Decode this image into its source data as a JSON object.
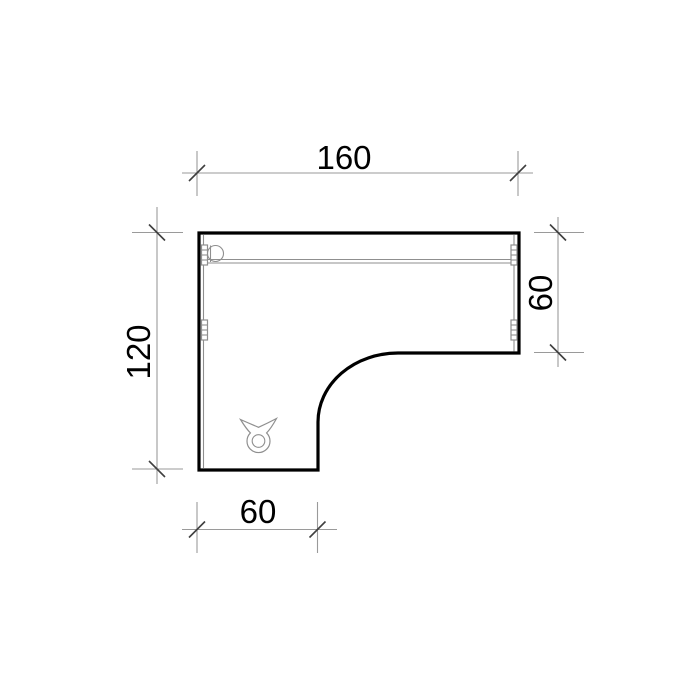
{
  "drawing": {
    "dimensions": {
      "top": {
        "label": "160",
        "value": 160
      },
      "left": {
        "label": "120",
        "value": 120
      },
      "right": {
        "label": "60",
        "value": 60
      },
      "bottom": {
        "label": "60",
        "value": 60
      }
    },
    "icons": {
      "grommet": "cable-grommet-icon",
      "fitting": "circle-fitting-icon",
      "bracket": "edge-bracket-icon"
    },
    "colors": {
      "outline": "#000000",
      "detail": "#8f8f8f",
      "dimension_line": "#9a9a9a",
      "tick": "#3f3f3f",
      "text": "#000000",
      "background": "#ffffff"
    }
  }
}
